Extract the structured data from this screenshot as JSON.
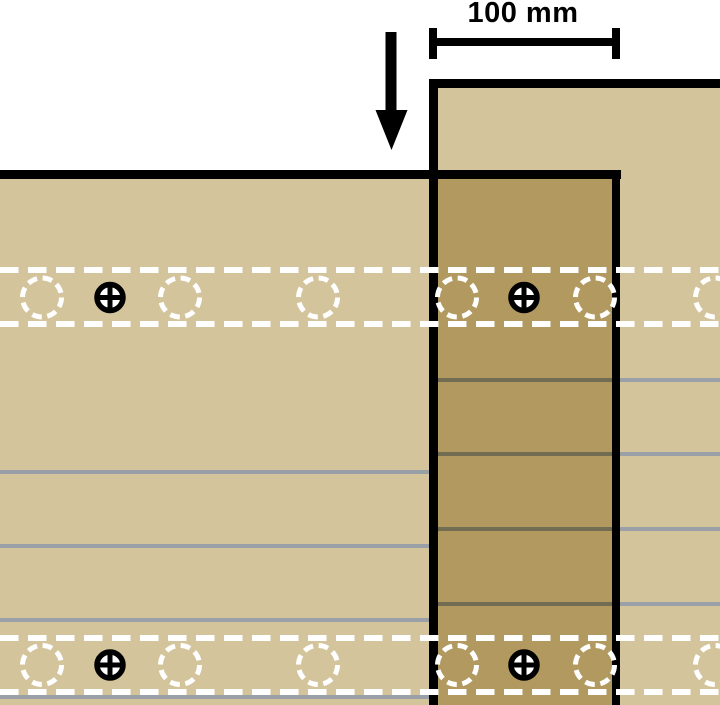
{
  "diagram": {
    "kind": "timber-lap-joint-section",
    "canvas": {
      "width": 720,
      "height": 705,
      "background": "#ffffff"
    },
    "colors": {
      "member_fill": "#d3c49c",
      "overlap_fill": "#b19960",
      "outline": "#000000",
      "lamination_light": "#9aa0a8",
      "lamination_dark": "#716c52",
      "glue_line": "#ffffff",
      "marker_white": "#ffffff",
      "marker_black": "#000000"
    },
    "members": {
      "horizontal_member": {
        "x": 0,
        "y": 172,
        "width": 620,
        "height": 533,
        "top_edge": {
          "x": 0,
          "y": 170,
          "width": 621,
          "height": 9
        },
        "right_edge": {
          "x": 612,
          "y": 170,
          "width": 8,
          "height": 535
        }
      },
      "vertical_member": {
        "x": 429,
        "y": 79,
        "width": 291,
        "height": 626,
        "top_edge": {
          "x": 429,
          "y": 79,
          "width": 291,
          "height": 9
        },
        "left_edge": {
          "x": 429,
          "y": 79,
          "width": 9,
          "height": 626
        }
      },
      "overlap_region": {
        "x": 438,
        "y": 175,
        "width": 174,
        "height": 530
      }
    },
    "laminations": {
      "thickness": 4,
      "lines": [
        {
          "y": 472,
          "x1": 0,
          "x2": 429,
          "tone": "light"
        },
        {
          "y": 546,
          "x1": 0,
          "x2": 429,
          "tone": "light"
        },
        {
          "y": 620,
          "x1": 0,
          "x2": 429,
          "tone": "light"
        },
        {
          "y": 697,
          "x1": 0,
          "x2": 429,
          "tone": "light"
        },
        {
          "y": 380,
          "x1": 438,
          "x2": 612,
          "tone": "dark"
        },
        {
          "y": 454,
          "x1": 438,
          "x2": 612,
          "tone": "dark"
        },
        {
          "y": 529,
          "x1": 438,
          "x2": 612,
          "tone": "dark"
        },
        {
          "y": 604,
          "x1": 438,
          "x2": 612,
          "tone": "dark"
        },
        {
          "y": 380,
          "x1": 612,
          "x2": 720,
          "tone": "light"
        },
        {
          "y": 454,
          "x1": 612,
          "x2": 720,
          "tone": "light"
        },
        {
          "y": 529,
          "x1": 612,
          "x2": 720,
          "tone": "light"
        },
        {
          "y": 604,
          "x1": 612,
          "x2": 720,
          "tone": "light"
        }
      ]
    },
    "glue_bands": {
      "line_thickness": 6,
      "dash": "18.5 9.5",
      "bands": [
        {
          "name": "upper",
          "top_line_y": 270,
          "bottom_line_y": 324,
          "marker_cy": 297.5
        },
        {
          "name": "lower",
          "top_line_y": 638,
          "bottom_line_y": 692,
          "marker_cy": 665
        }
      ]
    },
    "fasteners": {
      "predrilled_hole_x": [
        42,
        180,
        318,
        457,
        595,
        715
      ],
      "predrilled_hole_radius": 19.5,
      "predrilled_stroke": 5,
      "predrilled_dash": "9.8 5.6",
      "screw_x": [
        110,
        524
      ],
      "screw_radius": 13,
      "screw_ring_stroke": 5.5,
      "screw_cross_stroke": 5,
      "screw_cross_reach": 15.5
    },
    "dimension": {
      "label": "100 mm",
      "label_center_x": 523,
      "bar": {
        "x": 429,
        "y": 38,
        "width": 191,
        "height": 8
      },
      "tick_left": {
        "x": 429,
        "y": 28,
        "width": 8,
        "height": 31
      },
      "tick_right": {
        "x": 612,
        "y": 28,
        "width": 8,
        "height": 31
      }
    },
    "load_arrow": {
      "shaft": {
        "x": 385.5,
        "y": 32,
        "width": 11,
        "height": 80
      },
      "head_points": "375.5,110 407.5,110 391.5,150"
    }
  }
}
